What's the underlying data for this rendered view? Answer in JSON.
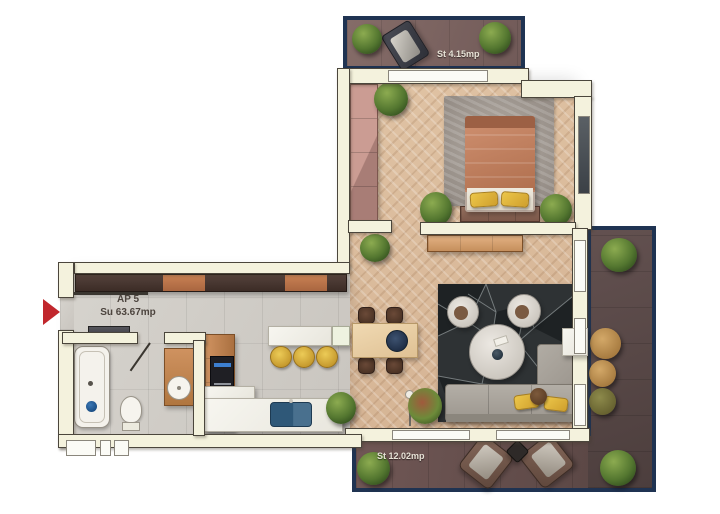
{
  "floorplan": {
    "unit_label": "AP 5",
    "unit_area": "Su 63.67mp",
    "terrace_top_label": "St 4.15mp",
    "terrace_bottom_label": "St 12.02mp"
  },
  "colors": {
    "wall": "#f4f2dd",
    "terrace_border": "#1f3352",
    "entrance_arrow": "#c1272d",
    "label_light": "#e7e2d6",
    "label_dark": "#4c443e",
    "wood_floor": "#d8b896",
    "tile_floor": "#cfccc6",
    "terrace_floor_top": "#7b6361",
    "terrace_floor_bottom": "#65504e",
    "terrace_floor_right": "#564644",
    "sofa_gray": "#a7a29a",
    "bed_duvet": "#c2805f",
    "accent_yellow": "#dfb23c",
    "sink_navy": "#2f5878"
  }
}
